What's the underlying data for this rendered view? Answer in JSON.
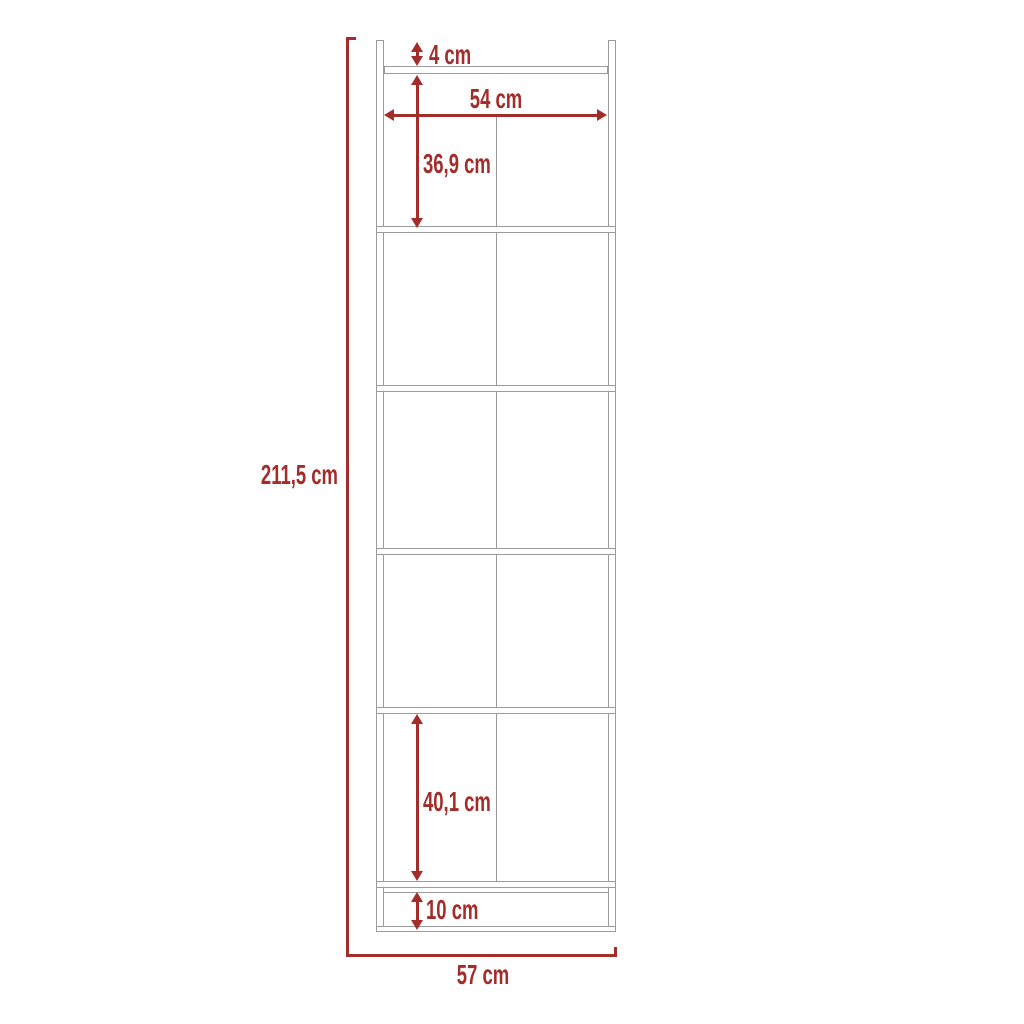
{
  "diagram": {
    "kind": "furniture-dimension-diagram",
    "dimensions": {
      "top_gap": "4 cm",
      "interior_width": "54 cm",
      "top_section_height": "36,9 cm",
      "total_height": "211,5 cm",
      "bottom_section_height": "40,1 cm",
      "base_height": "10 cm",
      "total_width": "57 cm"
    }
  },
  "colors": {
    "dimension_red": "#A22D2B",
    "structure_grey": "#9B9B9B",
    "background": "#FFFFFF"
  }
}
